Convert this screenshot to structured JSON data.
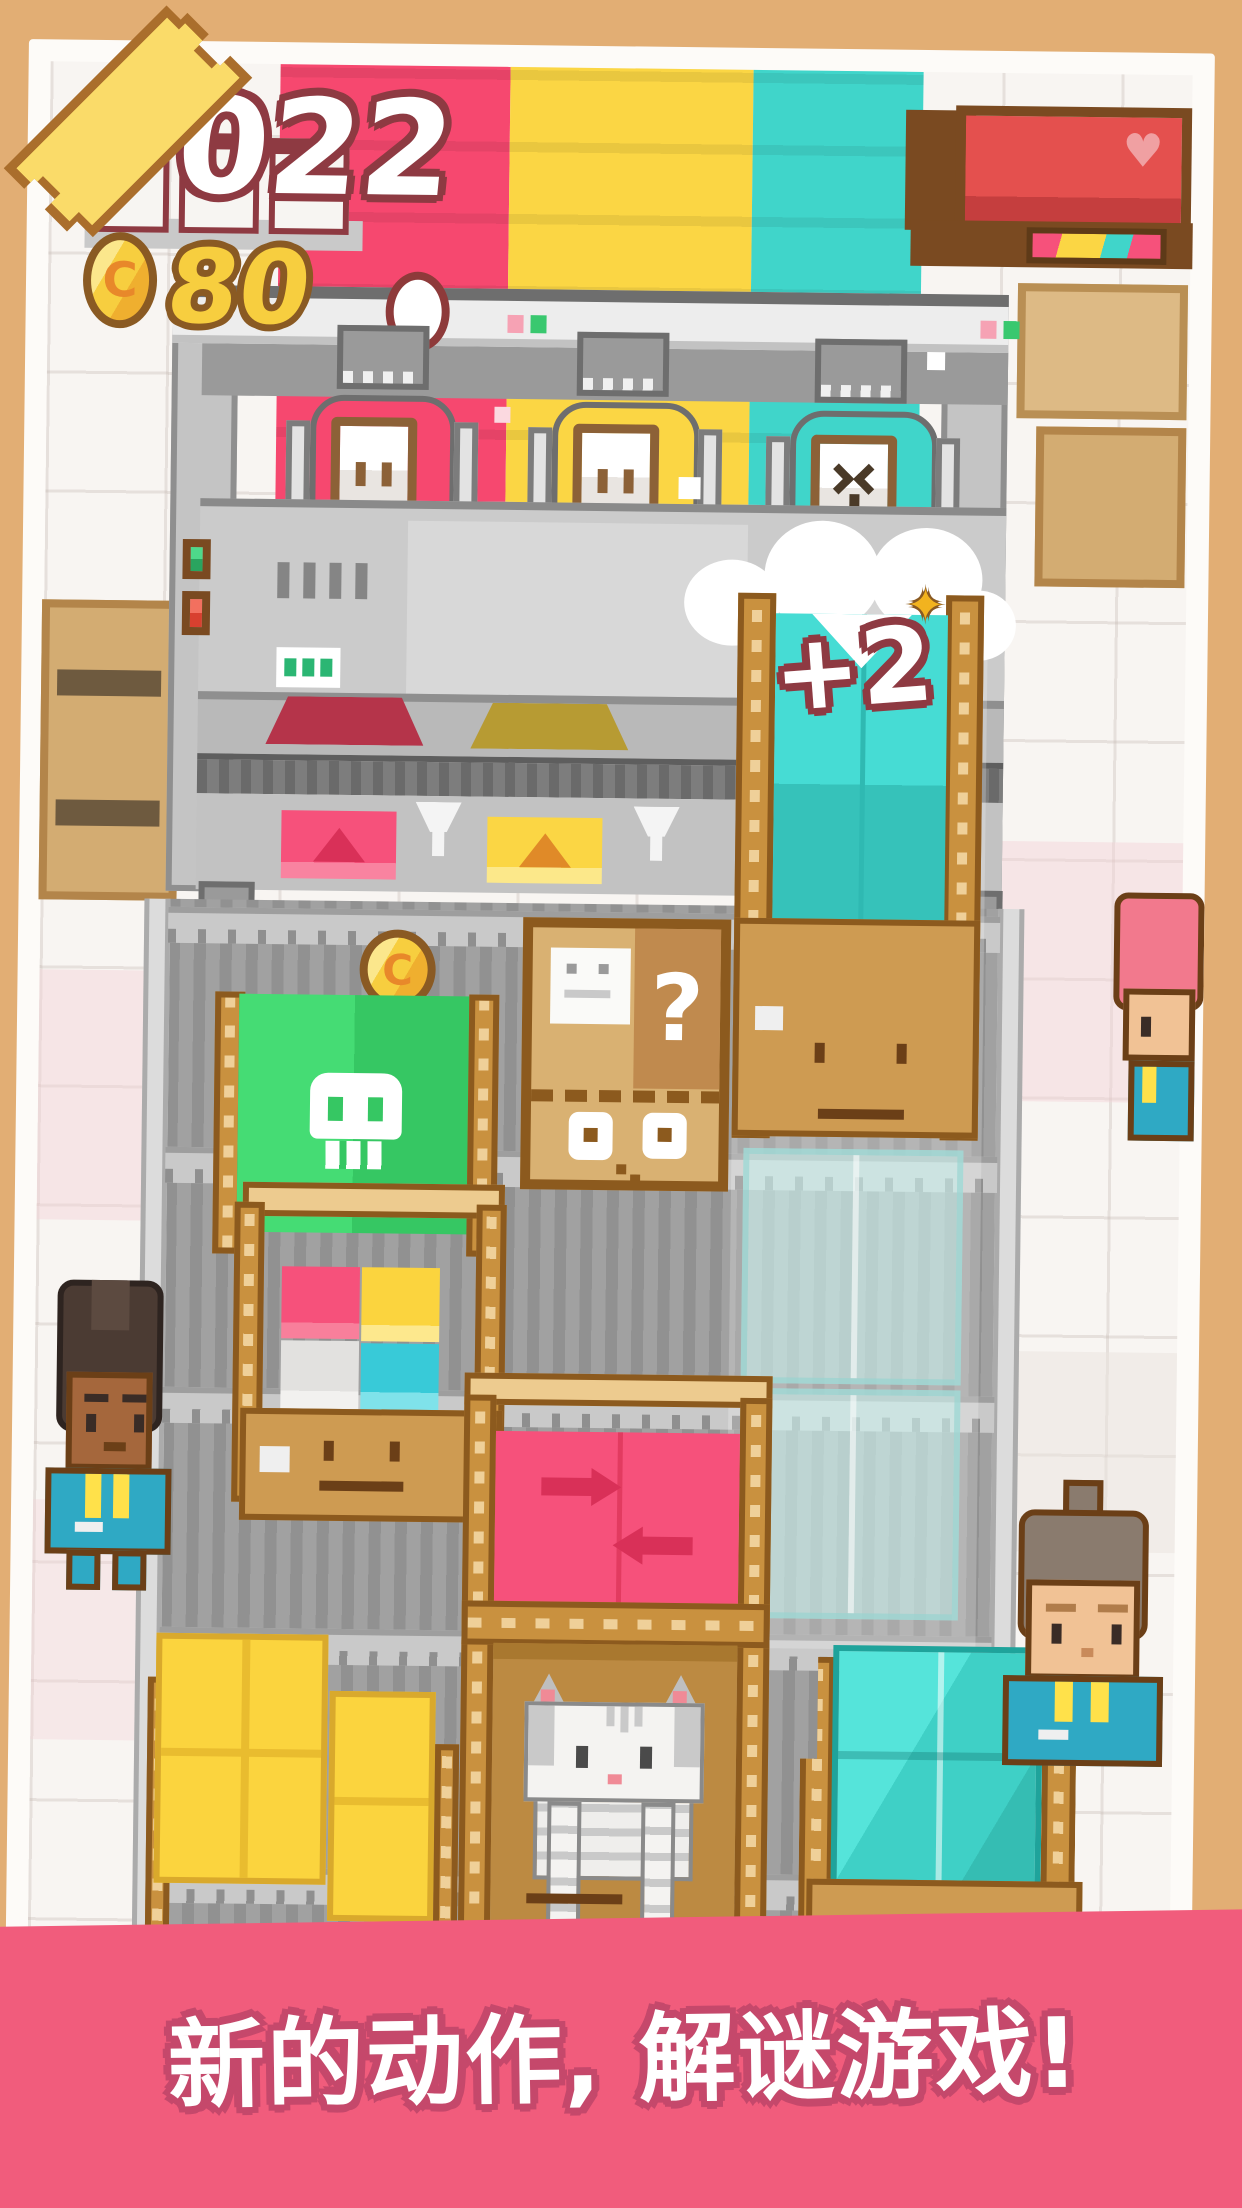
{
  "meta": {
    "description": "pixel-art factory puzzle game promo screenshot"
  },
  "hud": {
    "score": "022",
    "coin_symbol": "C",
    "coin_count": "80"
  },
  "popup": {
    "bonus_label": "+2",
    "sparkle_glyph": "✦"
  },
  "signs": {
    "heart_glyph": "♥"
  },
  "boxes": {
    "question_glyph": "?"
  },
  "banner": {
    "text": "新的动作, 解谜游戏!"
  },
  "palette": {
    "background_tan": "#E2AE74",
    "card_white": "#FDFBF8",
    "banner_pink": "#F15C7C",
    "banner_outline": "#C5486B",
    "wall_pink": "#F6486F",
    "wall_yellow": "#FBD644",
    "wall_teal": "#40D5CA",
    "wood": "#C9913F",
    "wood_dark": "#8C5A1E",
    "cardboard": "#D9B172",
    "green_box": "#3FD66E",
    "coin_gold": "#F7CE3F",
    "machine_gray": "#A6A6A6",
    "outfit_teal": "#2FA9C4",
    "outfit_yellow": "#FFE14A"
  }
}
